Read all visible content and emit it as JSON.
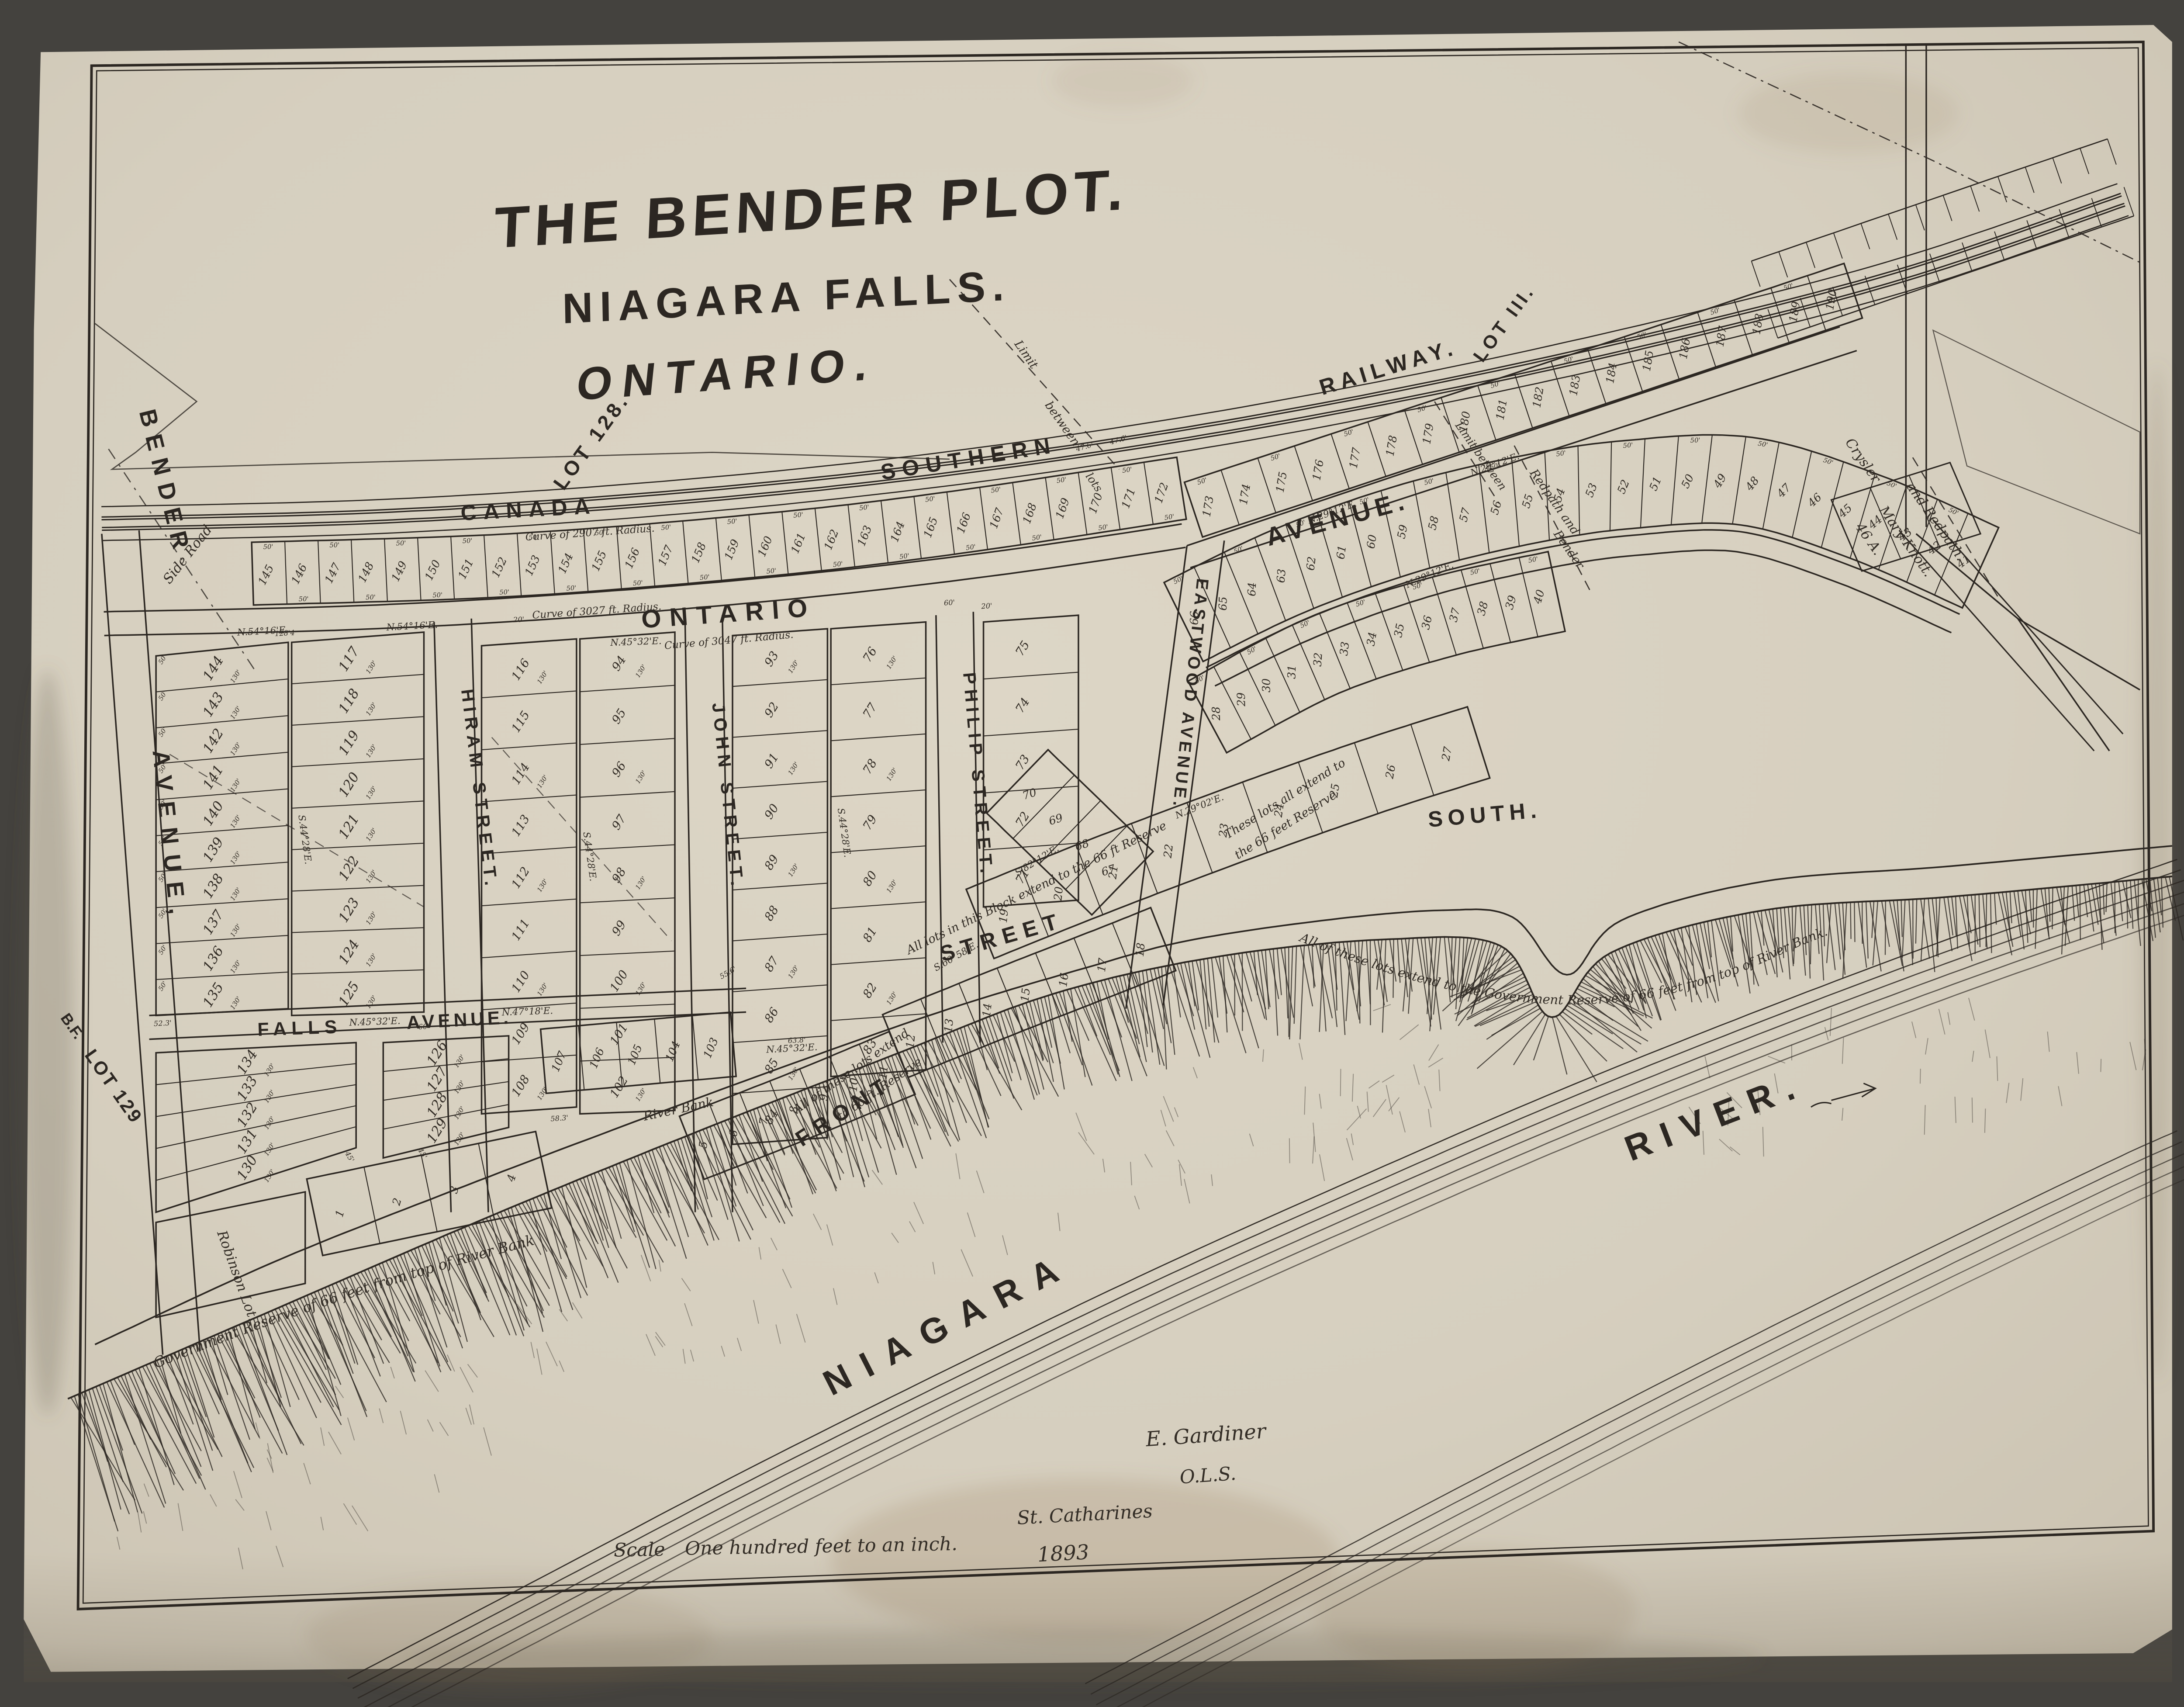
{
  "title": {
    "line1": "THE BENDER PLOT.",
    "line2": "NIAGARA FALLS.",
    "line3": "ONTARIO."
  },
  "railway": {
    "word1": "CANADA",
    "word2": "SOUTHERN",
    "word3": "RAILWAY."
  },
  "corner_labels": {
    "lot128": "LOT 128.",
    "lot111": "LOT III.",
    "bf": "B.F.",
    "lot129": "LOT 129"
  },
  "streets": {
    "bender_1": "BENDER",
    "bender_2": "AVENUE,",
    "hiram": "HIRAM  STREET.",
    "john": "JOHN  STREET.",
    "philip": "PHILIP  STREET.",
    "eastwood": "EASTWOOD AVENUE.",
    "falls_1": "FALLS",
    "falls_2": "AVENUE.",
    "ontario_1": "ONTARIO",
    "ontario_2": "AVENUE.",
    "front": "FRONT",
    "street_mid": "STREET",
    "south": "SOUTH.",
    "niagara": "NIAGARA",
    "river": "RIVER."
  },
  "annotations": {
    "reserve_sw": "Government   Reserve   of   66   feet   from   top   of   River   Bank",
    "reserve_e": "All of these lots extend to the   Government   Reserve   of   66   feet   from   top   of   River   Bank.",
    "these_lots_1": "These lots all extend to",
    "these_lots_2": "the 66 feet Reserve",
    "all_block": "All lots in this Block extend to the 66 ft Reserve",
    "all_12_1": "All of these lots extend",
    "all_12_2": "to 66 ft. Reserve",
    "river_bank": "River  Bank",
    "robinson": "Robinson  Lot.",
    "crysler": "Crysler",
    "mary_knott": "Mary Knott.",
    "and_redpath": "and Redpath.",
    "redpath_and": "Redpath and",
    "bender_dash": "Bender",
    "limit": "Limit",
    "between": "between",
    "limit_between": "Limit between",
    "lots_word": "lots",
    "side_road": "Side Road",
    "lot_46a": "46 A."
  },
  "bearings": {
    "b1": "N.54°16'E.",
    "b2": "N.45°32'E.",
    "b3": "S.44°28'E.",
    "b4": "N.47°18'E.",
    "b5": "N.29°12'E.",
    "b6": "N.29°02'E.",
    "b7": "S.60°58'E.",
    "b8": "S.82°12'E."
  },
  "curve_notes": {
    "c1": "Curve  of  2907 ft.  Radius.",
    "c2": "Curve  of  3027 ft.  Radius.",
    "c3": "Curve  of  3047 ft.  Radius."
  },
  "dims": {
    "w50": "50'",
    "w476": "47.6'",
    "d120": "120'",
    "d130": "130'",
    "w60": "60'",
    "w45": "45'",
    "w556": "55.6'",
    "w638": "63.8'",
    "w523": "52.3'",
    "w583": "58.3'",
    "w20": "20'",
    "w1284": "128'4"
  },
  "scale_line": {
    "word": "Scale",
    "text": "One hundred feet to an inch."
  },
  "signature": {
    "name": "E. Gardiner",
    "title": "O.L.S.",
    "place": "St. Catharines",
    "year": "1893"
  },
  "blocks": {
    "railway_row_west": [
      145,
      146,
      147,
      148,
      149,
      150,
      151,
      152,
      153,
      154,
      155,
      156,
      157,
      158,
      159,
      160,
      161,
      162,
      163,
      164,
      165,
      166,
      167,
      168,
      169,
      170,
      171,
      172
    ],
    "railway_row_east": [
      173,
      174,
      175,
      176,
      177,
      178,
      179,
      180,
      181,
      182,
      183,
      184,
      185,
      186,
      187,
      188,
      189,
      190
    ],
    "ontario_south_band": [
      66,
      65,
      64,
      63,
      62,
      61,
      60,
      59,
      58,
      57,
      56,
      55,
      54,
      53,
      52,
      51,
      50,
      49,
      48,
      47,
      46,
      45,
      44,
      43,
      42,
      41
    ],
    "block_28_40": [
      28,
      29,
      30,
      31,
      32,
      33,
      34,
      35,
      36,
      37,
      38,
      39,
      40
    ],
    "block_19_27": [
      19,
      20,
      21,
      22,
      23,
      24,
      25,
      26,
      27
    ],
    "block_12_18": [
      12,
      13,
      14,
      15,
      16,
      17,
      18
    ],
    "block_5_11": [
      5,
      6,
      7,
      8,
      9,
      10,
      11
    ],
    "block_1_4": [
      1,
      2,
      3,
      4
    ],
    "col_bender_hiram_w": [
      144,
      143,
      142,
      141,
      140,
      139,
      138,
      137,
      136,
      135
    ],
    "col_bender_hiram_e": [
      117,
      118,
      119,
      120,
      121,
      122,
      123,
      124,
      125
    ],
    "col_hiram_john_w": [
      116,
      115,
      114,
      113,
      112,
      111,
      110,
      109,
      108
    ],
    "col_hiram_john_e": [
      94,
      95,
      96,
      97,
      98,
      99,
      100,
      101,
      102
    ],
    "col_john_philip_w": [
      93,
      92,
      91,
      90,
      89,
      88,
      87,
      86,
      85,
      84
    ],
    "col_john_philip_e": [
      76,
      77,
      78,
      79,
      80,
      81,
      82,
      83
    ],
    "col_philip_eastwood": [
      75,
      74,
      73,
      72,
      71
    ],
    "lots_67_70": [
      70,
      69,
      68,
      67
    ],
    "col_falls_s_bender_hiram": [
      134,
      133,
      132,
      131,
      130
    ],
    "col_falls_s_hiram_john": [
      126,
      127,
      128,
      129
    ],
    "row_falls_s_john": [
      107,
      106,
      105,
      104,
      103
    ]
  },
  "colors": {
    "paper": "#d8d1c1",
    "ink": "#2c2722",
    "backdrop": "#44423e",
    "faded_ink": "#4a443a"
  }
}
